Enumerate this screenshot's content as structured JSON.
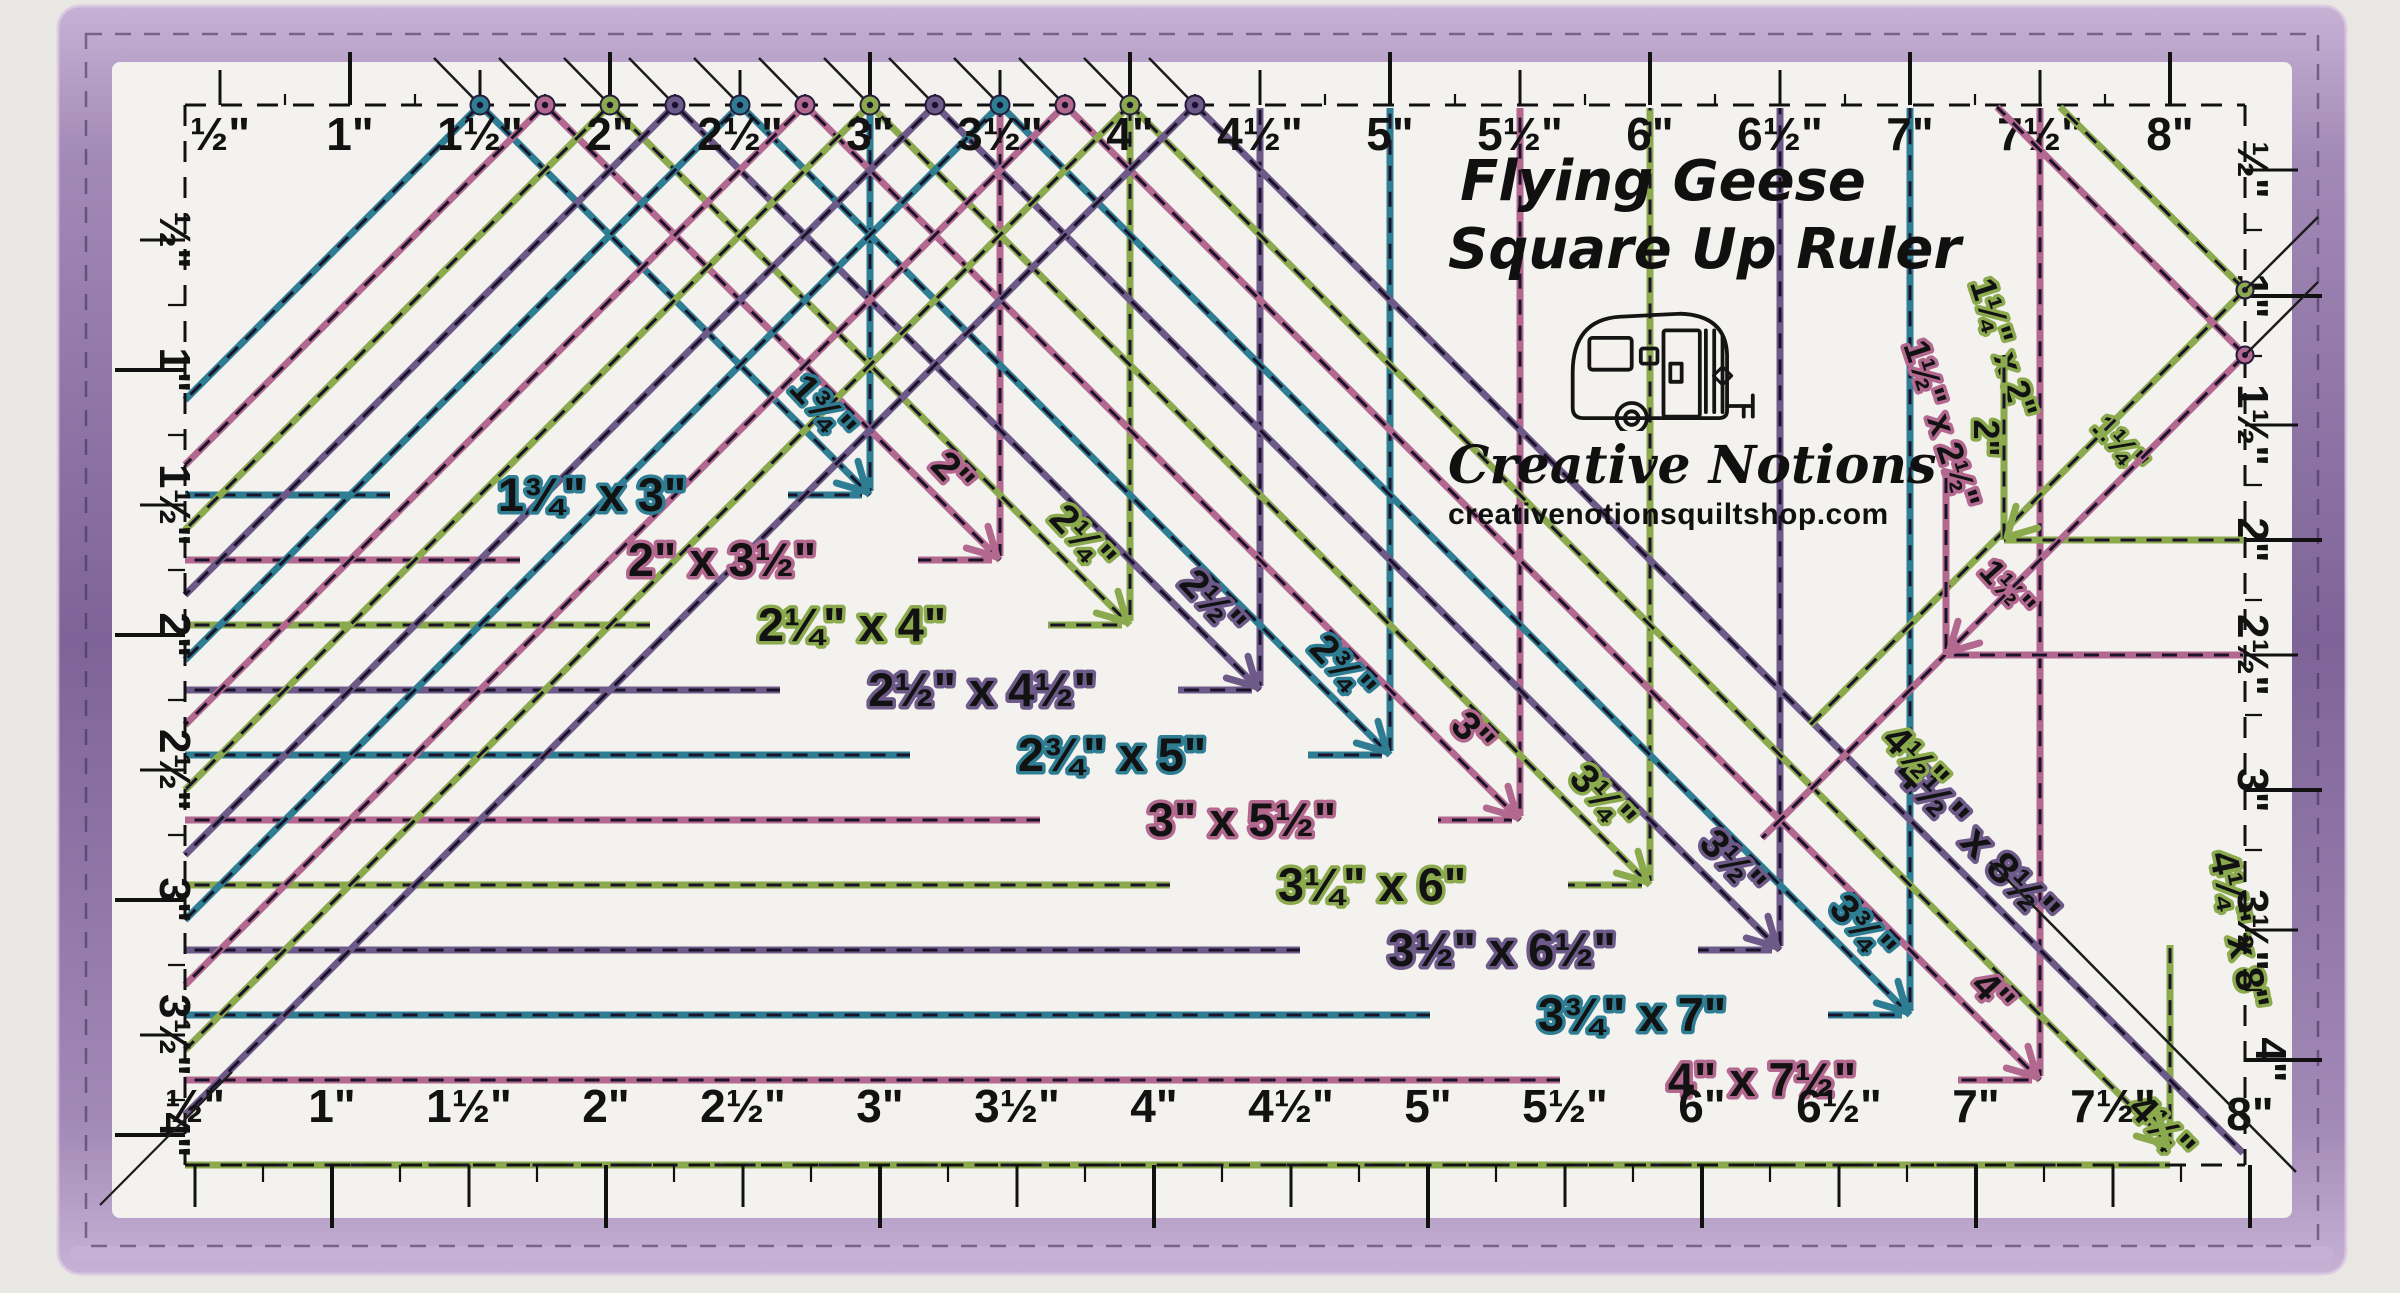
{
  "title": {
    "line1": "Flying Geese",
    "line2": "Square Up Ruler"
  },
  "brand": {
    "name": "Creative Notions",
    "website": "creativenotionsquiltshop.com",
    "logo_icon": "camper-trailer-icon"
  },
  "scales": {
    "top": [
      "½\"",
      "1\"",
      "1½\"",
      "2\"",
      "2½\"",
      "3\"",
      "3½\"",
      "4\"",
      "4½\"",
      "5\"",
      "5½\"",
      "6\"",
      "6½\"",
      "7\"",
      "7½\"",
      "8\""
    ],
    "bottom": [
      "½\"",
      "1\"",
      "1½\"",
      "2\"",
      "2½\"",
      "3\"",
      "3½\"",
      "4\"",
      "4½\"",
      "5\"",
      "5½\"",
      "6\"",
      "6½\"",
      "7\"",
      "7½\"",
      "8\""
    ],
    "left": [
      "½\"",
      "1\"",
      "1½\"",
      "2\"",
      "2½\"",
      "3\"",
      "3½\"",
      "4\""
    ],
    "right": [
      "½\"",
      "1\"",
      "1½\"",
      "2\"",
      "2½\"",
      "3\"",
      "3½\"",
      "4\""
    ]
  },
  "geese_units": [
    {
      "size": "1¾\" x 3\"",
      "tick_label": "1¾\"",
      "width_in": 1.75,
      "height_in": 3,
      "color": "teal"
    },
    {
      "size": "2\" x 3½\"",
      "tick_label": "2\"",
      "width_in": 2,
      "height_in": 3.5,
      "color": "pink"
    },
    {
      "size": "2¼\" x 4\"",
      "tick_label": "2¼\"",
      "width_in": 2.25,
      "height_in": 4,
      "color": "green"
    },
    {
      "size": "2½\" x 4½\"",
      "tick_label": "2½\"",
      "width_in": 2.5,
      "height_in": 4.5,
      "color": "purple"
    },
    {
      "size": "2¾\" x 5\"",
      "tick_label": "2¾\"",
      "width_in": 2.75,
      "height_in": 5,
      "color": "teal"
    },
    {
      "size": "3\" x 5½\"",
      "tick_label": "3\"",
      "width_in": 3,
      "height_in": 5.5,
      "color": "pink"
    },
    {
      "size": "3¼\" x 6\"",
      "tick_label": "3¼\"",
      "width_in": 3.25,
      "height_in": 6,
      "color": "green"
    },
    {
      "size": "3½\" x 6½\"",
      "tick_label": "3½\"",
      "width_in": 3.5,
      "height_in": 6.5,
      "color": "purple"
    },
    {
      "size": "3¾\" x 7\"",
      "tick_label": "3¾\"",
      "width_in": 3.75,
      "height_in": 7,
      "color": "teal"
    },
    {
      "size": "4\" x 7½\"",
      "tick_label": "4\"",
      "width_in": 4,
      "height_in": 7.5,
      "color": "pink"
    },
    {
      "size": "4¼\" x 8\"",
      "tick_label": "4¼\"",
      "width_in": 4.25,
      "height_in": 8,
      "color": "green",
      "rotated_label": true
    },
    {
      "size": "4½\" x 8½\"",
      "tick_label": "4½\"",
      "tick_color": "green",
      "width_in": 4.5,
      "height_in": 8.5,
      "color": "purple",
      "rotated_label": true
    }
  ],
  "small_geese_units": [
    {
      "size": "1¼\" x 2\"",
      "tick_label": "1¼\"",
      "corner_label": "2\"",
      "width_in": 1.25,
      "height_in": 2,
      "color": "green"
    },
    {
      "size": "1½\" x 2½\"",
      "tick_label": "1½\"",
      "width_in": 1.5,
      "height_in": 2.5,
      "color": "pink"
    }
  ],
  "palette": {
    "teal": "#2e7d93",
    "pink": "#b2688f",
    "green": "#8baa4e",
    "purple": "#6e5a88",
    "band": "#a289b6",
    "band_dark": "#7e6398",
    "band_light": "#c7b2d5",
    "surface": "#f4f2ee",
    "backdrop": "#e9e7e3",
    "ink": "#121212",
    "dash": "#1a1228"
  }
}
